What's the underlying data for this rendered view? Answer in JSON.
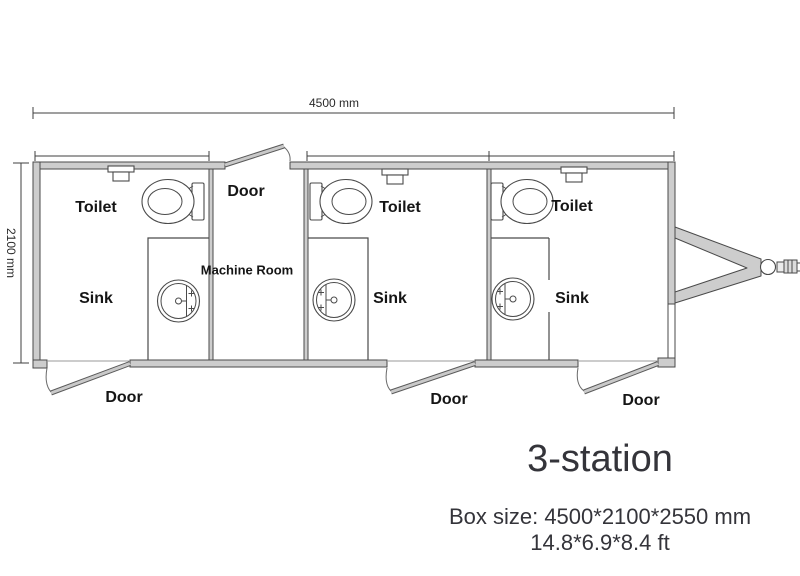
{
  "plan": {
    "dimension_width_label": "4500 mm",
    "dimension_height_label": "2100 mm",
    "machine_room_label": "Machine Room",
    "top_door_label": "Door",
    "stations": [
      {
        "toilet_label": "Toilet",
        "sink_label": "Sink",
        "door_label": "Door"
      },
      {
        "toilet_label": "Toilet",
        "sink_label": "Sink",
        "door_label": "Door"
      },
      {
        "toilet_label": "Toilet",
        "sink_label": "Sink",
        "door_label": "Door"
      }
    ],
    "icons": {
      "toilet": "toilet-icon",
      "sink": "sink-icon",
      "roof_vent": "vent-icon",
      "door_swing": "door-swing-icon",
      "trailer_hitch": "trailer-hitch-icon"
    }
  },
  "footer": {
    "title": "3-station",
    "box_size_mm": "Box size: 4500*2100*2550 mm",
    "box_size_ft": "14.8*6.9*8.4 ft"
  },
  "colors": {
    "background": "#ffffff",
    "wall_fill": "#cdcdcd",
    "line": "#4a4a4a",
    "label_text": "#151515",
    "footer_text": "#34343a"
  }
}
